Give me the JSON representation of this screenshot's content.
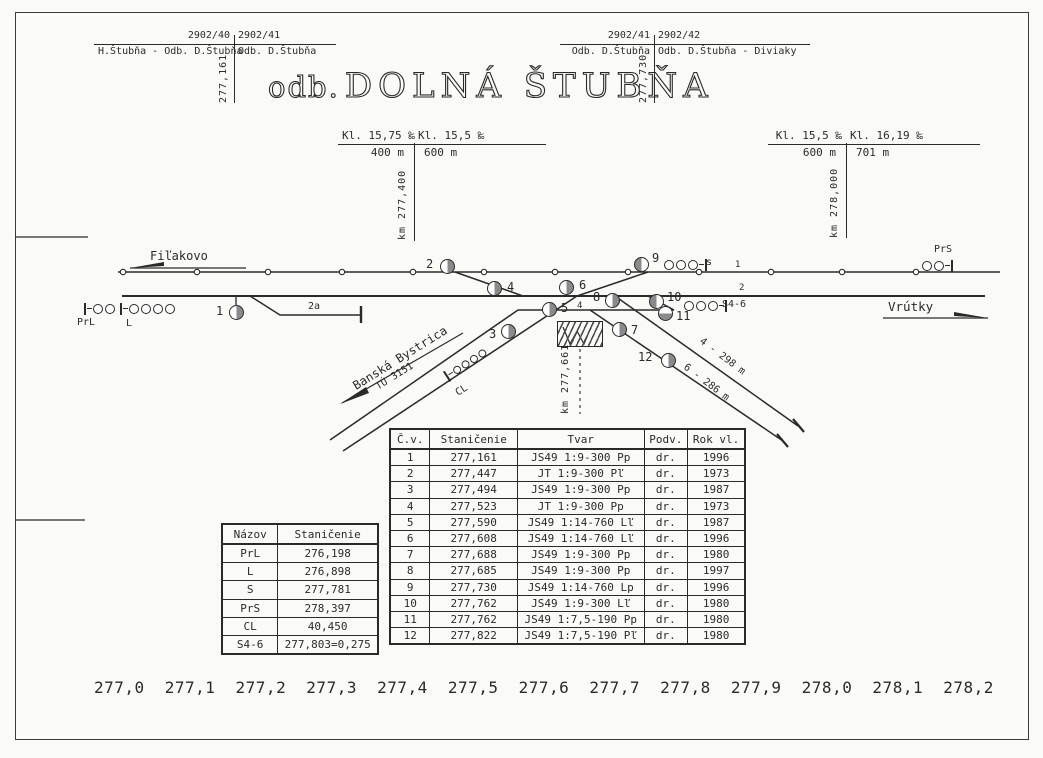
{
  "colors": {
    "ink": "#2a2a2a",
    "switch_fill": "#8a8a8a",
    "paper": "#fafaf7"
  },
  "title": {
    "prefix": "odb.",
    "name": "DOLNÁ ŠTUBŇA"
  },
  "route_markers": {
    "left": {
      "number_left": "2902/40",
      "number_right": "2902/41",
      "name_left": "H.Štubňa - Odb. D.Štubňa",
      "name_right": "Odb. D.Štubňa",
      "km": "277,161"
    },
    "right": {
      "number_left": "2902/41",
      "number_right": "2902/42",
      "name_left": "Odb. D.Štubňa",
      "name_right": "Odb. D.Štubňa - Diviaky",
      "km": "277,730"
    }
  },
  "gradient_markers": {
    "left": {
      "grade_left": "Kl. 15,75 ‰",
      "grade_right": "Kl. 15,5 ‰",
      "length_left": "400 m",
      "length_right": "600 m",
      "km": "km 277,400"
    },
    "right": {
      "grade_left": "Kl. 15,5 ‰",
      "grade_right": "Kl. 16,19 ‰",
      "length_left": "600 m",
      "length_right": "701 m",
      "km": "km 278,000"
    }
  },
  "directions": {
    "west": "Fiľakovo",
    "east": "Vrútky",
    "branch": "Banská Bystrica",
    "branch_section": "TÚ 3151"
  },
  "track_labels": {
    "line1": "1",
    "line2": "2",
    "siding_2a": "2a",
    "track4": "4",
    "stub4": "4 - 298 m",
    "stub6": "6 - 286 m"
  },
  "signals": {
    "prl": "PrL",
    "l": "L",
    "s": "s",
    "s4_6": "S4-6",
    "prs": "PrS",
    "cl": "CL"
  },
  "level_crossing": {
    "km": "km 277,661"
  },
  "diagram": {
    "switch_labels": [
      "1",
      "2",
      "3",
      "4",
      "5",
      "6",
      "7",
      "8",
      "9",
      "10",
      "11",
      "12"
    ]
  },
  "switch_table": {
    "headers": [
      "Č.v.",
      "Staničenie",
      "Tvar",
      "Podv.",
      "Rok vl."
    ],
    "rows": [
      [
        "1",
        "277,161",
        "JS49 1:9-300 Pp",
        "dr.",
        "1996"
      ],
      [
        "2",
        "277,447",
        "JT 1:9-300 Pľ",
        "dr.",
        "1973"
      ],
      [
        "3",
        "277,494",
        "JS49 1:9-300 Pp",
        "dr.",
        "1987"
      ],
      [
        "4",
        "277,523",
        "JT 1:9-300 Pp",
        "dr.",
        "1973"
      ],
      [
        "5",
        "277,590",
        "JS49 1:14-760 Lľ",
        "dr.",
        "1987"
      ],
      [
        "6",
        "277,608",
        "JS49 1:14-760 Lľ",
        "dr.",
        "1996"
      ],
      [
        "7",
        "277,688",
        "JS49 1:9-300 Pp",
        "dr.",
        "1980"
      ],
      [
        "8",
        "277,685",
        "JS49 1:9-300 Pp",
        "dr.",
        "1997"
      ],
      [
        "9",
        "277,730",
        "JS49 1:14-760 Lp",
        "dr.",
        "1996"
      ],
      [
        "10",
        "277,762",
        "JS49 1:9-300 Lľ",
        "dr.",
        "1980"
      ],
      [
        "11",
        "277,762",
        "JS49 1:7,5-190 Pp",
        "dr.",
        "1980"
      ],
      [
        "12",
        "277,822",
        "JS49 1:7,5-190 Pľ",
        "dr.",
        "1980"
      ]
    ]
  },
  "signal_table": {
    "headers": [
      "Názov",
      "Staničenie"
    ],
    "rows": [
      [
        "PrL",
        "276,198"
      ],
      [
        "L",
        "276,898"
      ],
      [
        "S",
        "277,781"
      ],
      [
        "PrS",
        "278,397"
      ],
      [
        "CL",
        "40,450"
      ],
      [
        "S4-6",
        "277,803=0,275"
      ]
    ]
  },
  "km_scale": [
    "277,0",
    "277,1",
    "277,2",
    "277,3",
    "277,4",
    "277,5",
    "277,6",
    "277,7",
    "277,8",
    "277,9",
    "278,0",
    "278,1",
    "278,2"
  ]
}
